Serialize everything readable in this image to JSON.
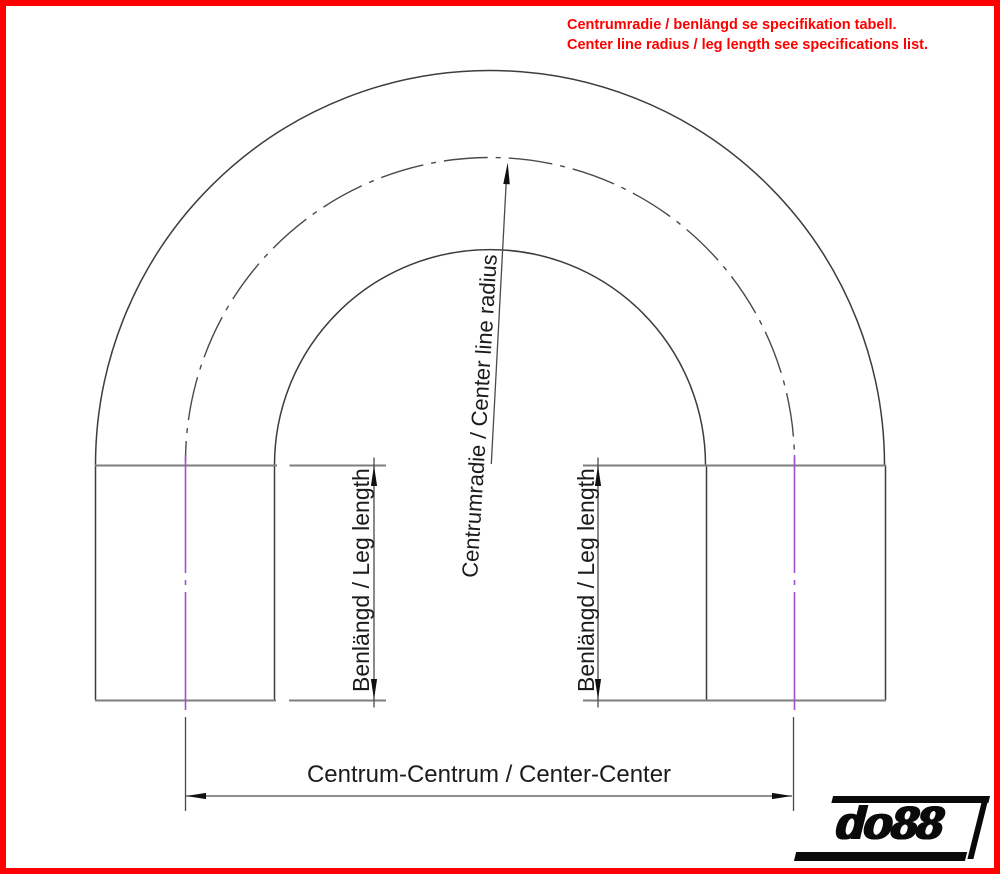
{
  "page": {
    "background": "#ffffff",
    "border_color": "#ff0000"
  },
  "note": {
    "line1": "Centrumradie / benlängd se specifikation tabell.",
    "line2": "Center line radius / leg length see specifications list.",
    "color": "#ff0000"
  },
  "dimensions": {
    "radius_label": "Centrumradie / Center line radius",
    "leg_left_label": "Benlängd / Leg length",
    "leg_right_label": "Benlängd / Leg length",
    "center_center_label": "Centrum-Centrum / Center-Center"
  },
  "drawing_colors": {
    "edges": "#3d3d3d",
    "dimension_lines": "#4a4a4a",
    "tangent_lines": "#7e7e7e",
    "leg_centerline_purple": "#a050d2",
    "arrowheads": "#111111"
  },
  "logo": {
    "text": "do88",
    "color": "#0a0a0a"
  }
}
